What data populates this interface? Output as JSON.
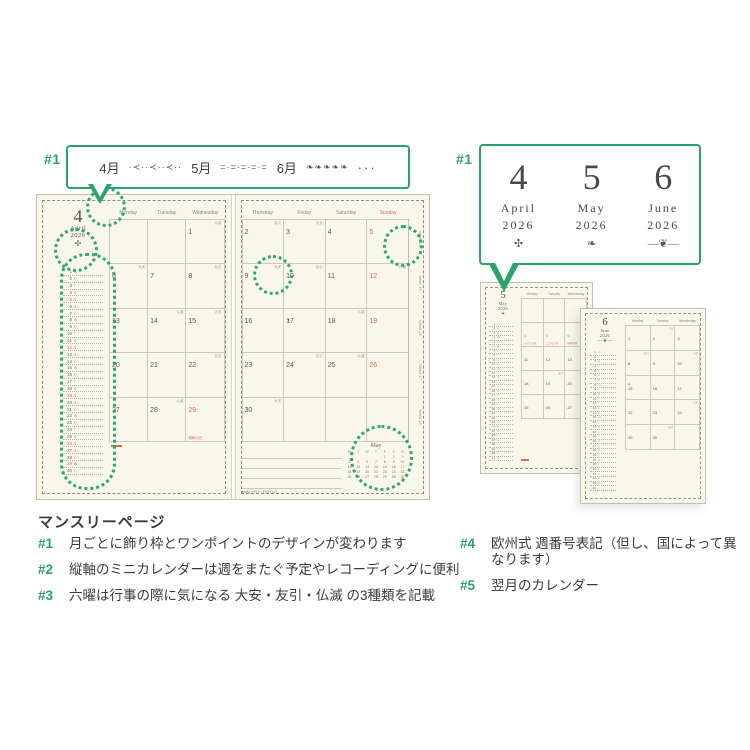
{
  "colors": {
    "accent_green": "#29a369",
    "holiday_red": "#d96a48",
    "page_cream": "#f9f6ec"
  },
  "annotations": {
    "a1": "#1",
    "a2": "#2",
    "a3": "#3",
    "a4": "#4",
    "a5": "#5"
  },
  "top_bubble": {
    "label": "#1",
    "months": [
      {
        "name": "4月",
        "pattern": "·≺··≺··≺··"
      },
      {
        "name": "5月",
        "pattern": "=·=·=·=·="
      },
      {
        "name": "6月",
        "pattern": "❧❧❧❧❧"
      }
    ],
    "more": "···"
  },
  "right_bubble": {
    "label": "#1",
    "months": [
      {
        "num": "4",
        "name": "April",
        "year": "2026",
        "ornament": "✣"
      },
      {
        "num": "5",
        "name": "May",
        "year": "2026",
        "ornament": "❧"
      },
      {
        "num": "6",
        "name": "June",
        "year": "2026",
        "ornament": "―❦―"
      }
    ]
  },
  "spread": {
    "left": {
      "month_num": "4",
      "month_name": "April",
      "year": "2026",
      "ornament": "✣",
      "headers": [
        "Monday",
        "Tuesday",
        "Wednesday"
      ],
      "weeks": [
        [
          [
            "",
            0,
            "",
            0
          ],
          [
            "",
            0,
            "",
            0
          ],
          [
            "1",
            0,
            "仏滅",
            0
          ]
        ],
        [
          [
            "6",
            0,
            "大安",
            0
          ],
          [
            "7",
            0,
            "",
            0
          ],
          [
            "8",
            0,
            "友引",
            0
          ]
        ],
        [
          [
            "13",
            0,
            "",
            0
          ],
          [
            "14",
            0,
            "仏滅",
            0
          ],
          [
            "15",
            0,
            "大安",
            0
          ]
        ],
        [
          [
            "20",
            0,
            "",
            0
          ],
          [
            "21",
            0,
            "",
            0
          ],
          [
            "22",
            0,
            "友引",
            0
          ]
        ],
        [
          [
            "27",
            0,
            "",
            0
          ],
          [
            "28",
            0,
            "仏滅",
            0
          ],
          [
            "29",
            1,
            "昭和の日",
            1
          ]
        ]
      ],
      "mini": [
        [
          "1",
          "w",
          0
        ],
        [
          "2",
          "t",
          0
        ],
        [
          "3",
          "f",
          0
        ],
        [
          "4",
          "s",
          0
        ],
        [
          "5",
          "s",
          1
        ],
        [
          "6",
          "m",
          0
        ],
        [
          "7",
          "t",
          0
        ],
        [
          "8",
          "w",
          0
        ],
        [
          "9",
          "t",
          0
        ],
        [
          "10",
          "f",
          0
        ],
        [
          "11",
          "s",
          0
        ],
        [
          "12",
          "s",
          1
        ],
        [
          "13",
          "m",
          0
        ],
        [
          "14",
          "t",
          0
        ],
        [
          "15",
          "w",
          0
        ],
        [
          "16",
          "t",
          0
        ],
        [
          "17",
          "f",
          0
        ],
        [
          "18",
          "s",
          0
        ],
        [
          "19",
          "s",
          1
        ],
        [
          "20",
          "m",
          0
        ],
        [
          "21",
          "t",
          0
        ],
        [
          "22",
          "w",
          0
        ],
        [
          "23",
          "t",
          0
        ],
        [
          "24",
          "f",
          0
        ],
        [
          "25",
          "s",
          0
        ],
        [
          "26",
          "s",
          1
        ],
        [
          "27",
          "m",
          0
        ],
        [
          "28",
          "t",
          0
        ],
        [
          "29",
          "w",
          1
        ],
        [
          "30",
          "t",
          0
        ]
      ]
    },
    "right": {
      "headers": [
        "Thursday",
        "Friday",
        "Saturday",
        "Sunday"
      ],
      "weeks": [
        [
          [
            "2",
            0,
            "友引",
            0
          ],
          [
            "3",
            0,
            "大安",
            0
          ],
          [
            "4",
            0,
            "",
            0
          ],
          [
            "5",
            1,
            "",
            0
          ]
        ],
        [
          [
            "9",
            0,
            "大安",
            0
          ],
          [
            "10",
            0,
            "友引",
            0
          ],
          [
            "11",
            0,
            "",
            0
          ],
          [
            "12",
            1,
            "仏滅",
            0
          ]
        ],
        [
          [
            "16",
            0,
            "",
            0
          ],
          [
            "17",
            0,
            "●",
            0
          ],
          [
            "18",
            0,
            "仏滅",
            0
          ],
          [
            "19",
            1,
            "",
            0
          ]
        ],
        [
          [
            "23",
            0,
            "",
            0
          ],
          [
            "24",
            0,
            "友引",
            0
          ],
          [
            "25",
            0,
            "仏滅",
            0
          ],
          [
            "26",
            1,
            "",
            0
          ]
        ],
        [
          [
            "30",
            0,
            "大安",
            0
          ],
          [
            "",
            0,
            "",
            0
          ],
          [
            "",
            0,
            "",
            0
          ],
          [
            "",
            0,
            "",
            0
          ]
        ]
      ],
      "week_numbers": [
        "Week 14",
        "Week 15",
        "Week 16",
        "Week 17",
        "Week 18"
      ],
      "legend": "●NM ◑FQ ○FM ◐LQ",
      "next_month": {
        "title": "May",
        "day_letters": [
          "M",
          "T",
          "W",
          "T",
          "F",
          "S",
          "S"
        ],
        "weeks": [
          [
            [
              "",
              0
            ],
            [
              "",
              0
            ],
            [
              "",
              0
            ],
            [
              "",
              0
            ],
            [
              "1",
              0
            ],
            [
              "2",
              0
            ],
            [
              "3",
              1
            ]
          ],
          [
            [
              "4",
              1
            ],
            [
              "5",
              1
            ],
            [
              "6",
              1
            ],
            [
              "7",
              0
            ],
            [
              "8",
              0
            ],
            [
              "9",
              0
            ],
            [
              "10",
              1
            ]
          ],
          [
            [
              "11",
              0
            ],
            [
              "12",
              0
            ],
            [
              "13",
              0
            ],
            [
              "14",
              0
            ],
            [
              "15",
              0
            ],
            [
              "16",
              0
            ],
            [
              "17",
              1
            ]
          ],
          [
            [
              "18",
              0
            ],
            [
              "19",
              0
            ],
            [
              "20",
              0
            ],
            [
              "21",
              0
            ],
            [
              "22",
              0
            ],
            [
              "23",
              0
            ],
            [
              "24",
              1
            ]
          ],
          [
            [
              "25",
              0
            ],
            [
              "26",
              0
            ],
            [
              "27",
              0
            ],
            [
              "28",
              0
            ],
            [
              "29",
              0
            ],
            [
              "30",
              0
            ],
            [
              "31",
              1
            ]
          ]
        ]
      }
    }
  },
  "small_pages": [
    {
      "month_num": "5",
      "month_name": "May",
      "year": "2026",
      "ornament": "❧",
      "headers": [
        "Monday",
        "Tuesday",
        "Wednesday"
      ],
      "weeks": [
        [
          [
            "",
            0,
            "",
            0
          ],
          [
            "",
            0,
            "",
            0
          ],
          [
            "",
            0,
            "",
            0
          ]
        ],
        [
          [
            "4",
            1,
            "みどりの日",
            1
          ],
          [
            "5",
            1,
            "こどもの日",
            1
          ],
          [
            "6",
            1,
            "振替休日",
            1
          ]
        ],
        [
          [
            "11",
            0,
            "",
            0
          ],
          [
            "12",
            0,
            "",
            0
          ],
          [
            "13",
            0,
            "大安",
            0
          ]
        ],
        [
          [
            "18",
            0,
            "",
            0
          ],
          [
            "19",
            0,
            "友引",
            0
          ],
          [
            "20",
            0,
            "",
            0
          ]
        ],
        [
          [
            "25",
            0,
            "",
            0
          ],
          [
            "26",
            0,
            "",
            0
          ],
          [
            "27",
            0,
            "仏滅",
            0
          ]
        ]
      ],
      "mini": [
        [
          "1",
          "f",
          0
        ],
        [
          "2",
          "s",
          0
        ],
        [
          "3",
          "s",
          1
        ],
        [
          "4",
          "m",
          1
        ],
        [
          "5",
          "t",
          1
        ],
        [
          "6",
          "w",
          1
        ],
        [
          "7",
          "t",
          0
        ],
        [
          "8",
          "f",
          0
        ],
        [
          "9",
          "s",
          0
        ],
        [
          "10",
          "s",
          1
        ],
        [
          "11",
          "m",
          0
        ],
        [
          "12",
          "t",
          0
        ],
        [
          "13",
          "w",
          0
        ],
        [
          "14",
          "t",
          0
        ],
        [
          "15",
          "f",
          0
        ],
        [
          "16",
          "s",
          0
        ],
        [
          "17",
          "s",
          1
        ],
        [
          "18",
          "m",
          0
        ],
        [
          "19",
          "t",
          0
        ],
        [
          "20",
          "w",
          0
        ],
        [
          "21",
          "t",
          0
        ],
        [
          "22",
          "f",
          0
        ],
        [
          "23",
          "s",
          0
        ],
        [
          "24",
          "s",
          1
        ],
        [
          "25",
          "m",
          0
        ],
        [
          "26",
          "t",
          0
        ],
        [
          "27",
          "w",
          0
        ],
        [
          "28",
          "t",
          0
        ],
        [
          "29",
          "f",
          0
        ],
        [
          "30",
          "s",
          0
        ],
        [
          "31",
          "s",
          1
        ]
      ]
    },
    {
      "month_num": "6",
      "month_name": "June",
      "year": "2026",
      "ornament": "―❦―",
      "headers": [
        "Monday",
        "Tuesday",
        "Wednesday"
      ],
      "weeks": [
        [
          [
            "1",
            0,
            "",
            0
          ],
          [
            "2",
            0,
            "大安",
            0
          ],
          [
            "3",
            0,
            "",
            0
          ]
        ],
        [
          [
            "8",
            0,
            "友引",
            0
          ],
          [
            "9",
            0,
            "",
            0
          ],
          [
            "10",
            0,
            "仏滅",
            0
          ]
        ],
        [
          [
            "15",
            0,
            "●",
            0
          ],
          [
            "16",
            0,
            "",
            0
          ],
          [
            "17",
            0,
            "",
            0
          ]
        ],
        [
          [
            "22",
            0,
            "",
            0
          ],
          [
            "23",
            0,
            "",
            0
          ],
          [
            "24",
            0,
            "大安",
            0
          ]
        ],
        [
          [
            "29",
            0,
            "",
            0
          ],
          [
            "30",
            0,
            "友引",
            0
          ],
          [
            "",
            0,
            "",
            0
          ]
        ]
      ],
      "mini": [
        [
          "1",
          "m",
          0
        ],
        [
          "2",
          "t",
          0
        ],
        [
          "3",
          "w",
          0
        ],
        [
          "4",
          "t",
          0
        ],
        [
          "5",
          "f",
          0
        ],
        [
          "6",
          "s",
          0
        ],
        [
          "7",
          "s",
          1
        ],
        [
          "8",
          "m",
          0
        ],
        [
          "9",
          "t",
          0
        ],
        [
          "10",
          "w",
          0
        ],
        [
          "11",
          "t",
          0
        ],
        [
          "12",
          "f",
          0
        ],
        [
          "13",
          "s",
          0
        ],
        [
          "14",
          "s",
          1
        ],
        [
          "15",
          "m",
          0
        ],
        [
          "16",
          "t",
          0
        ],
        [
          "17",
          "w",
          0
        ],
        [
          "18",
          "t",
          0
        ],
        [
          "19",
          "f",
          0
        ],
        [
          "20",
          "s",
          0
        ],
        [
          "21",
          "s",
          1
        ],
        [
          "22",
          "m",
          0
        ],
        [
          "23",
          "t",
          0
        ],
        [
          "24",
          "w",
          0
        ],
        [
          "25",
          "t",
          0
        ],
        [
          "26",
          "f",
          0
        ],
        [
          "27",
          "s",
          0
        ],
        [
          "28",
          "s",
          1
        ],
        [
          "29",
          "m",
          0
        ],
        [
          "30",
          "t",
          0
        ]
      ]
    }
  ],
  "footer": {
    "heading": "マンスリーページ",
    "items_left": [
      {
        "tag": "#1",
        "text": "月ごとに飾り枠とワンポイントのデザインが変わります"
      },
      {
        "tag": "#2",
        "text": "縦軸のミニカレンダーは週をまたぐ予定やレコーディングに便利"
      },
      {
        "tag": "#3",
        "text": "六曜は行事の際に気になる 大安・友引・仏滅 の3種類を記載"
      }
    ],
    "items_right": [
      {
        "tag": "#4",
        "text": "欧州式 週番号表記（但し、国によって異なります）"
      },
      {
        "tag": "#5",
        "text": "翌月のカレンダー"
      }
    ]
  }
}
